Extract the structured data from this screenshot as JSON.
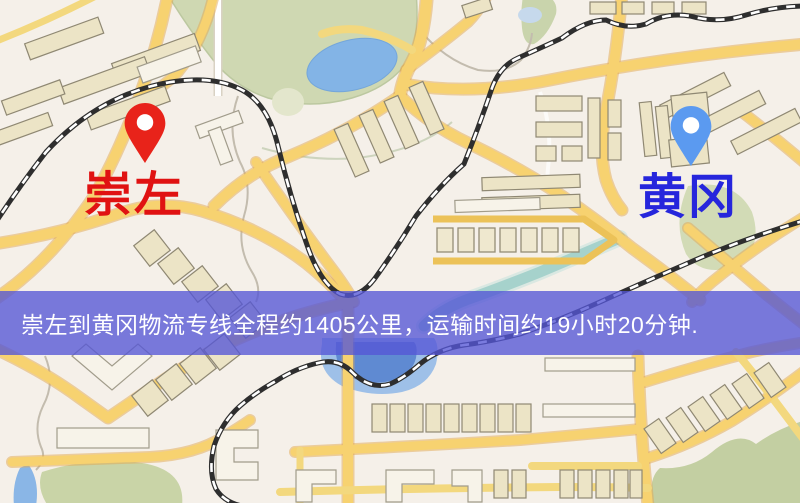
{
  "map": {
    "origin": {
      "label": "崇左",
      "pin_icon": "location-pin-icon",
      "pin_color": "#e8231a",
      "label_color": "#e01212"
    },
    "destination": {
      "label": "黄冈",
      "pin_icon": "location-pin-icon",
      "pin_color": "#5b9af0",
      "label_color": "#2626dc"
    },
    "banner": {
      "text": "崇左到黄冈物流专线全程约1405公里，运输时间约19小时20分钟.",
      "background": "#5456d6",
      "text_color": "#ffffff"
    },
    "route_summary": {
      "from": "崇左",
      "to": "黄冈",
      "distance_text": "约1405公里",
      "duration_text": "约19小时20分钟"
    },
    "palette": {
      "map_background": "#f5f0e9",
      "road_fill": "#f7d270",
      "road_casing": "#e2a850",
      "building_fill": "#ece4c6",
      "green_area": "#cfd8b2",
      "water_blue": "#83b4e6",
      "lake_deep_blue": "#5f8ad2",
      "river_teal": "#a6d2cc",
      "railway_dark": "#2e2e2e"
    }
  }
}
